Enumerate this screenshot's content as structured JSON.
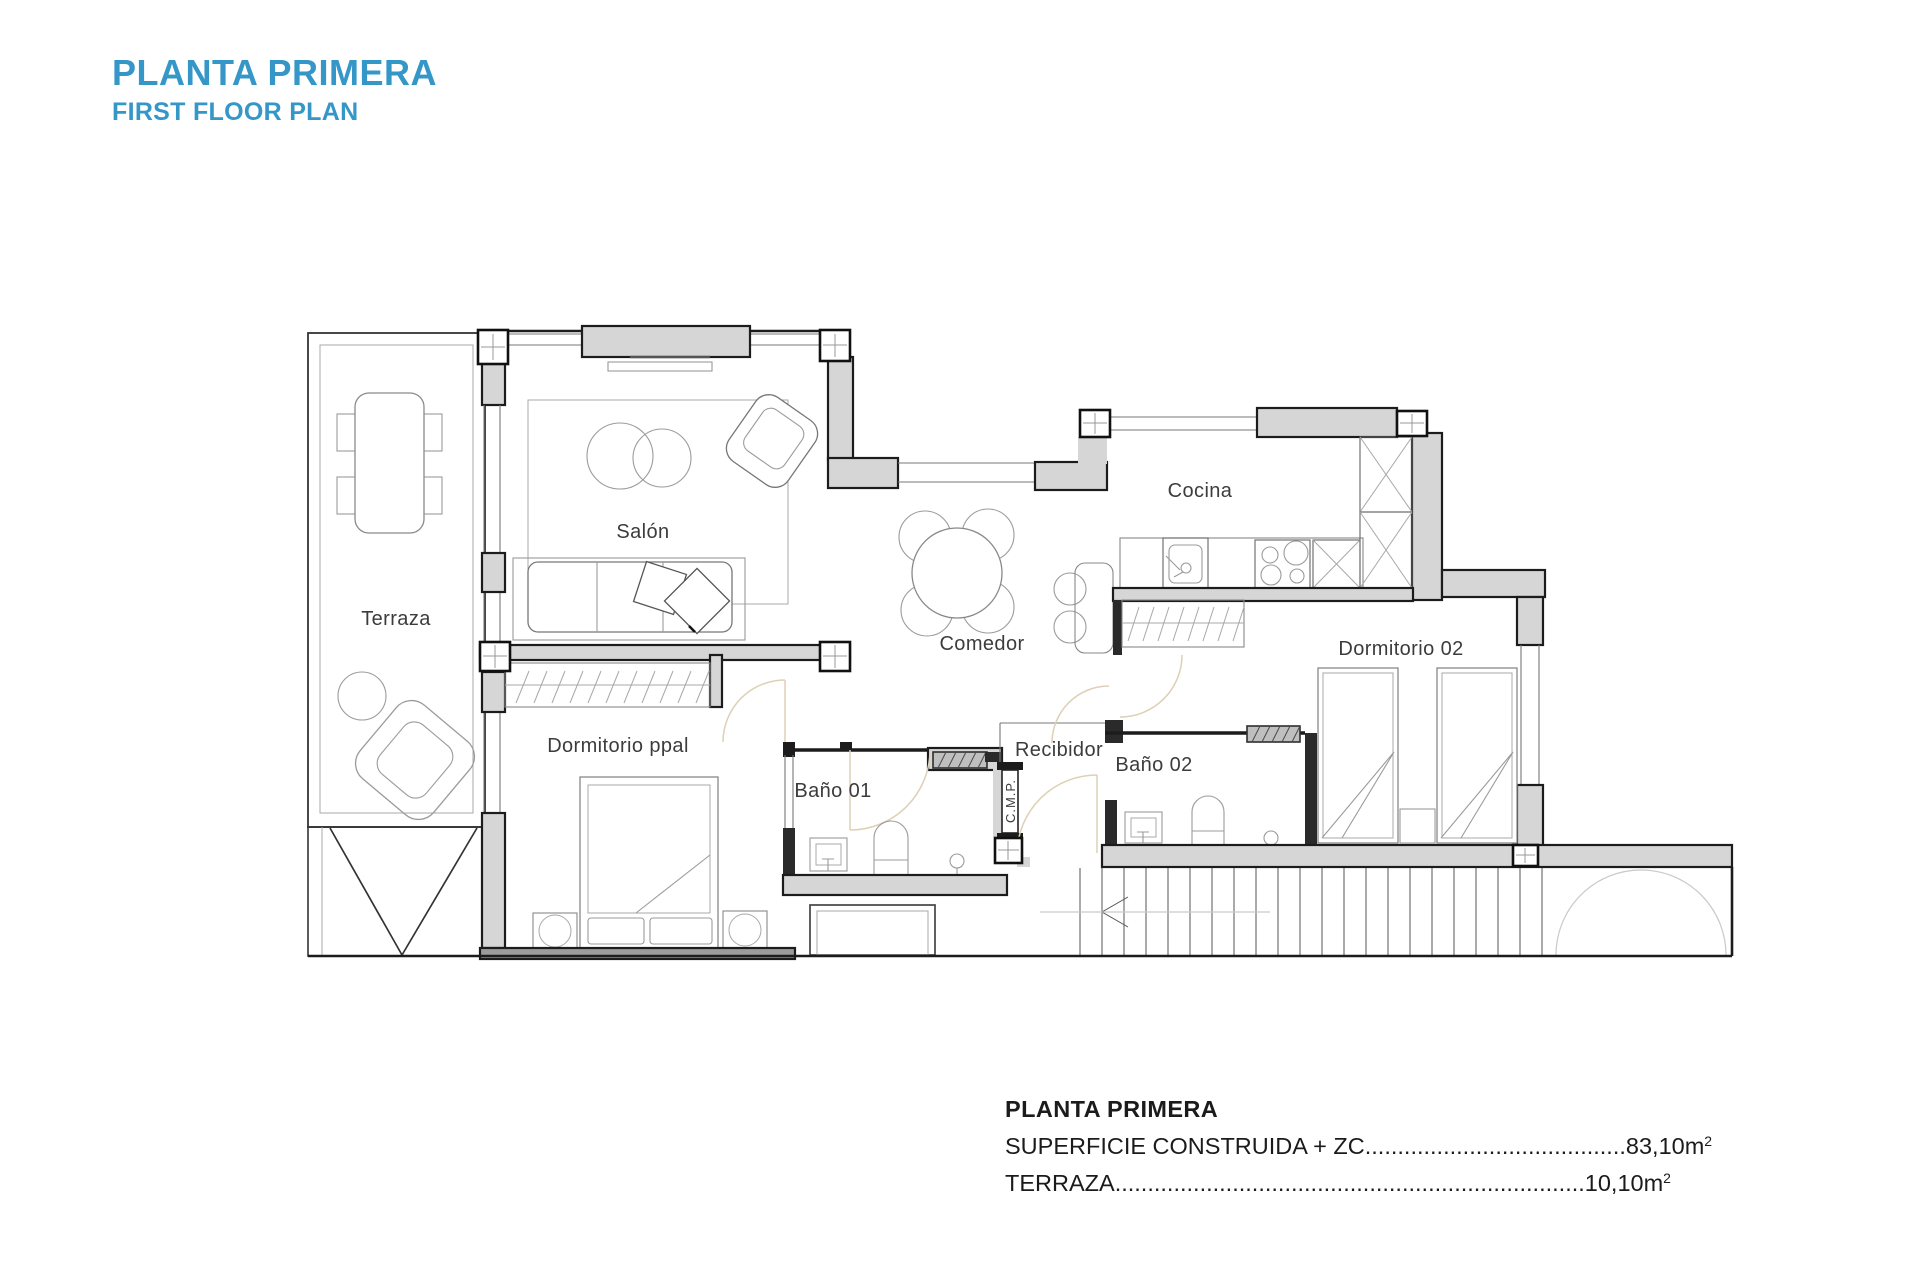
{
  "header": {
    "title": "PLANTA PRIMERA",
    "subtitle": "FIRST FLOOR PLAN"
  },
  "rooms": {
    "terraza": "Terraza",
    "salon": "Salón",
    "comedor": "Comedor",
    "cocina": "Cocina",
    "dormitorio02": "Dormitorio 02",
    "dormitorio_ppal": "Dormitorio ppal",
    "bano01": "Baño 01",
    "recibidor": "Recibidor",
    "bano02": "Baño 02",
    "cmp": "C.M.P."
  },
  "summary": {
    "title": "PLANTA PRIMERA",
    "lines": [
      {
        "label": "SUPERFICIE CONSTRUIDA + ZC",
        "leader": "........................................",
        "value": "83,10m",
        "sup": "2"
      },
      {
        "label": "TERRAZA",
        "leader": "........................................................................",
        "value": "10,10m",
        "sup": "2"
      }
    ]
  },
  "colors": {
    "accent": "#3596c8",
    "wall_fill": "#d6d6d6",
    "wall_line": "#1c1c1c",
    "door_arc": "#ddd0b6"
  }
}
